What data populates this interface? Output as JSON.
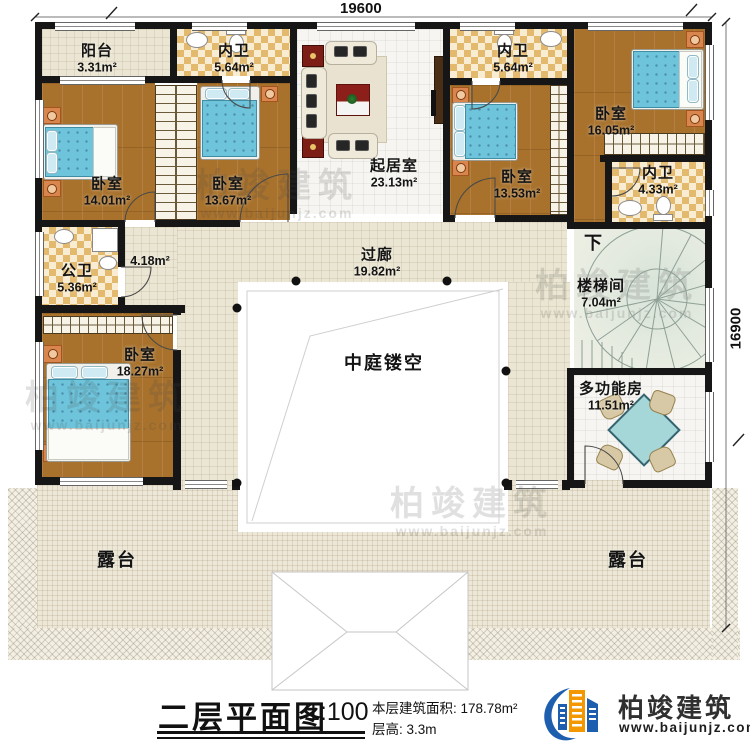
{
  "dimensions": {
    "top": "19600",
    "right": "16900"
  },
  "rooms": {
    "balcony": {
      "name": "阳台",
      "area": "3.31m²"
    },
    "bath1": {
      "name": "内卫",
      "area": "5.64m²"
    },
    "bath2": {
      "name": "内卫",
      "area": "5.64m²"
    },
    "bath3": {
      "name": "内卫",
      "area": "4.33m²"
    },
    "bed1": {
      "name": "卧室",
      "area": "14.01m²"
    },
    "bed2": {
      "name": "卧室",
      "area": "13.67m²"
    },
    "bed3": {
      "name": "卧室",
      "area": "13.53m²"
    },
    "bed4": {
      "name": "卧室",
      "area": "16.05m²"
    },
    "bed5": {
      "name": "卧室",
      "area": "18.27m²"
    },
    "living": {
      "name": "起居室",
      "area": "23.13m²"
    },
    "pubbath": {
      "name": "公卫",
      "area": "5.36m²"
    },
    "hall": {
      "area": "4.18m²"
    },
    "corridor": {
      "name": "过廊",
      "area": "19.82m²"
    },
    "atrium": {
      "name": "中庭镂空"
    },
    "stair": {
      "name": "楼梯间",
      "area": "7.04m²",
      "down": "下"
    },
    "multi": {
      "name": "多功能房",
      "area": "11.51m²"
    },
    "terrace_left": {
      "name": "露台"
    },
    "terrace_right": {
      "name": "露台"
    }
  },
  "titleblock": {
    "title": "二层平面图",
    "scale": "1:100",
    "floor_area": "本层建筑面积: 178.78m²",
    "floor_height": "层高: 3.3m"
  },
  "logo": {
    "name": "柏竣建筑",
    "url": "www.baijunjz.com"
  },
  "watermark": {
    "name": "柏竣建筑",
    "url": "www.baijunjz.com"
  },
  "colors": {
    "wall": "#161616",
    "wood_floor": "#a8722d",
    "tile_floor": "#ebe6d3",
    "checker_floor": "#e3b96e",
    "bed_blue": "#6ec4da",
    "logo_blue": "#1d5fae",
    "logo_orange": "#f39800",
    "stair_green": "#d7e3d8"
  }
}
